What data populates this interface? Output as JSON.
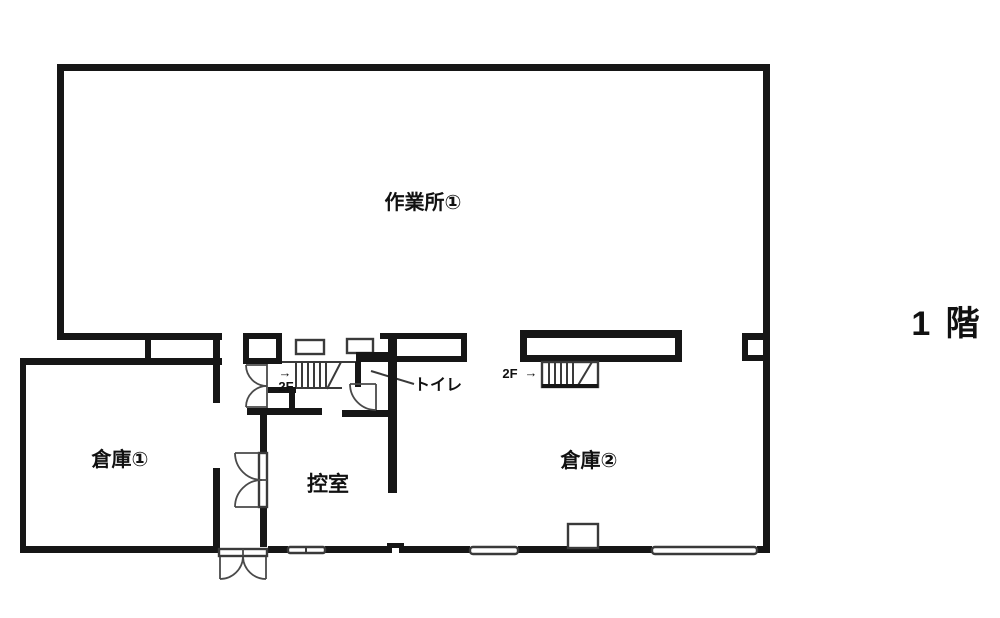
{
  "floor_plan": {
    "floor_title": "1 階",
    "rooms": [
      {
        "id": "workshop-1",
        "label": "作業所①"
      },
      {
        "id": "warehouse-1",
        "label": "倉庫①"
      },
      {
        "id": "warehouse-2",
        "label": "倉庫②"
      },
      {
        "id": "waiting-room",
        "label": "控室"
      },
      {
        "id": "toilet",
        "label": "トイレ"
      }
    ],
    "stairs": [
      {
        "id": "center-stair",
        "label": "2F",
        "arrow": "→"
      },
      {
        "id": "east-stair",
        "label": "2F",
        "arrow": "→"
      }
    ],
    "colors": {
      "wall": "#161616",
      "thin_line": "#3a3a3a",
      "door_line": "#4a4a4a",
      "background": "#ffffff"
    }
  }
}
